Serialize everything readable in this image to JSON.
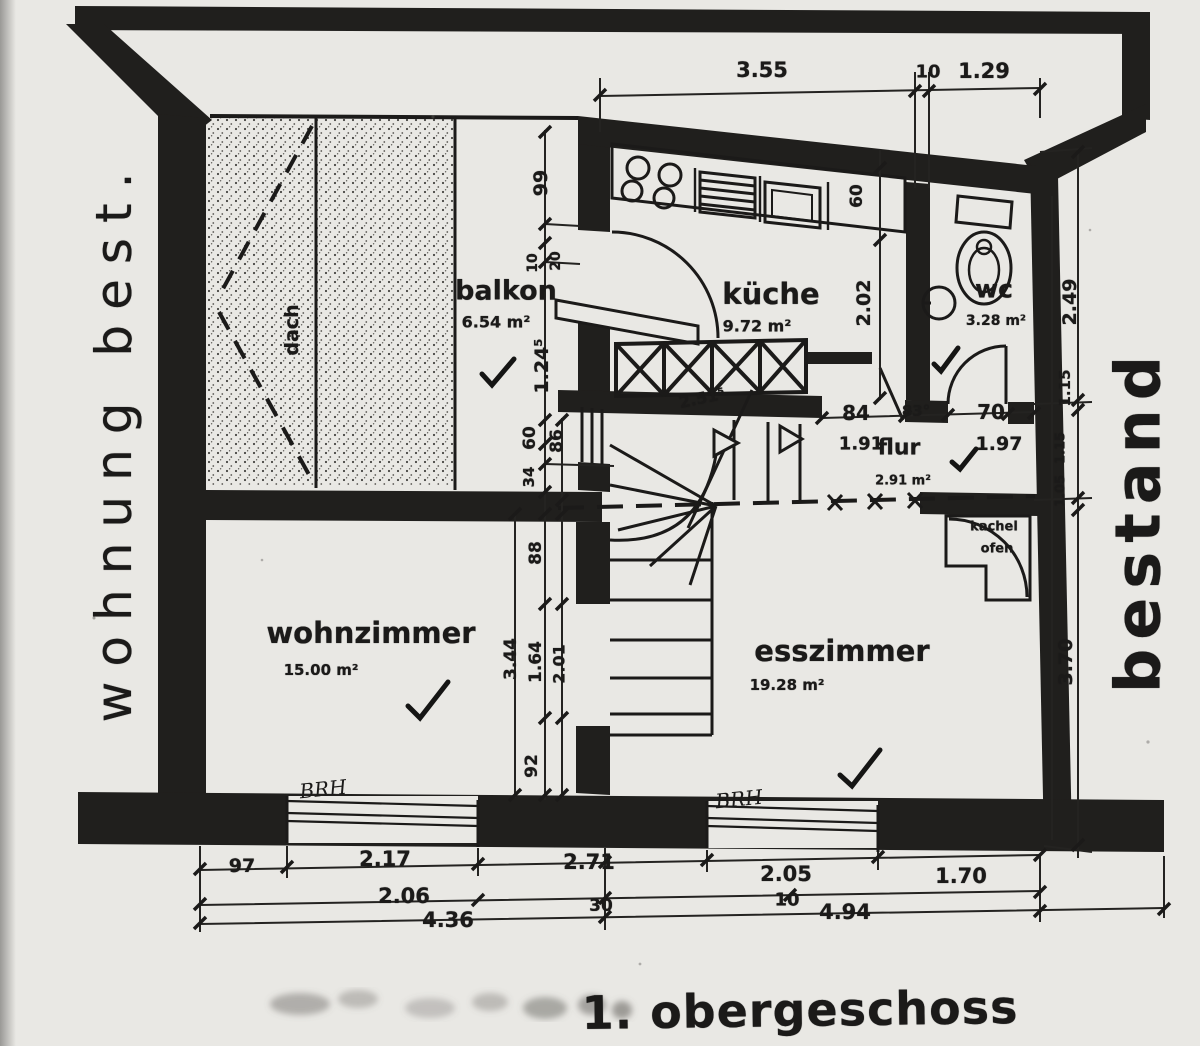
{
  "title": "1. obergeschoss",
  "margin_labels": {
    "left_vertical": "wohnung best.",
    "right_vertical": "bestand"
  },
  "rooms": {
    "dach": {
      "label": "dach"
    },
    "balkon": {
      "label": "balkon",
      "area": "6.54 m²"
    },
    "kueche": {
      "label": "küche",
      "area": "9.72 m²"
    },
    "wc": {
      "label": "wc",
      "area": "3.28 m²"
    },
    "flur": {
      "label": "flur",
      "area": "2.91 m²"
    },
    "wohnzimmer": {
      "label": "wohnzimmer",
      "area": "15.00 m²"
    },
    "esszimmer": {
      "label": "esszimmer",
      "area": "19.28 m²"
    },
    "kachelofen": {
      "line1": "kachel",
      "line2": "ofen"
    }
  },
  "handwritten": {
    "brh_left": "BRH",
    "brh_right": "BRH"
  },
  "dims": [
    "3.55",
    "10",
    "1.29",
    "99",
    "10",
    "20",
    "1.24⁵",
    "60",
    "86",
    "34",
    "88",
    "3.44",
    "1.64",
    "2.01",
    "92",
    "2.49",
    "1.15",
    "1.15",
    "1.05",
    "3.70",
    "60",
    "2.02",
    "84",
    "83°",
    "70",
    "1.91",
    "1.97",
    "2.51⁵",
    "97",
    "2.17",
    "2.06",
    "4.36",
    "2.71",
    "30",
    "2.05",
    "1.70",
    "10",
    "4.94"
  ]
}
